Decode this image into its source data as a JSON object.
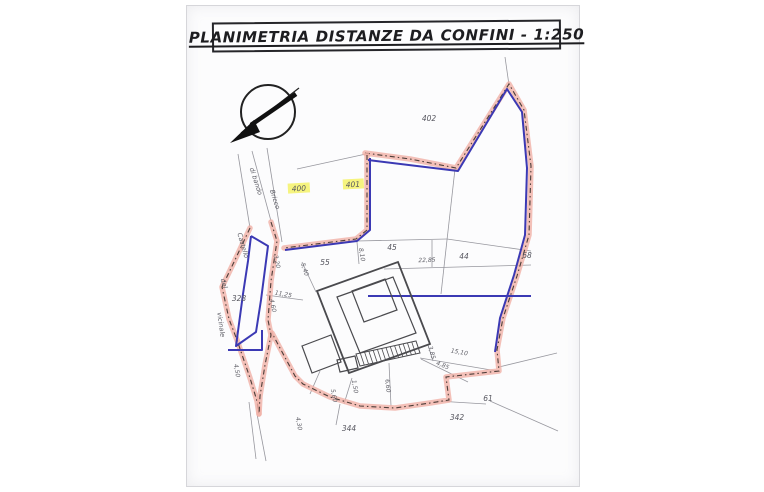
{
  "title": {
    "text": "PLANIMETRIA DISTANZE DA CONFINI - 1:250"
  },
  "colors": {
    "paper": "#fcfcfd",
    "pink_band": "#f0b0a6",
    "dash_ink": "#2e2622",
    "blue_line": "#3b39b4",
    "thin_line": "#97979e",
    "building": "#4a4a4e",
    "label": "#55555e",
    "dimension": "#606068",
    "road": "#5a5a62",
    "highlight": "#f4f268",
    "ink": "#222222"
  },
  "map": {
    "pink_boundaries": [
      {
        "name": "perimeter-east",
        "points": [
          [
            365,
            153
          ],
          [
            410,
            159
          ],
          [
            456,
            168
          ],
          [
            509,
            84
          ],
          [
            524,
            110
          ],
          [
            531,
            166
          ],
          [
            529,
            235
          ],
          [
            517,
            276
          ],
          [
            503,
            318
          ],
          [
            497,
            350
          ],
          [
            499,
            371
          ],
          [
            446,
            377
          ],
          [
            449,
            400
          ],
          [
            430,
            403
          ],
          [
            395,
            408
          ],
          [
            360,
            406
          ],
          [
            330,
            397
          ],
          [
            303,
            384
          ],
          [
            295,
            376
          ],
          [
            281,
            350
          ],
          [
            272,
            333
          ]
        ]
      },
      {
        "name": "road-west-band",
        "points": [
          [
            250,
            228
          ],
          [
            234,
            262
          ],
          [
            222,
            287
          ],
          [
            229,
            319
          ],
          [
            237,
            340
          ],
          [
            250,
            378
          ],
          [
            257,
            401
          ],
          [
            259,
            414
          ]
        ]
      },
      {
        "name": "road-middle-band",
        "points": [
          [
            271,
            222
          ],
          [
            277,
            241
          ],
          [
            271,
            281
          ],
          [
            268,
            320
          ],
          [
            271,
            335
          ],
          [
            265,
            365
          ],
          [
            260,
            396
          ],
          [
            259,
            414
          ]
        ]
      },
      {
        "name": "north-court-band",
        "points": [
          [
            367,
            155
          ],
          [
            367,
            230
          ],
          [
            356,
            239
          ],
          [
            284,
            248
          ]
        ]
      }
    ],
    "blue_lines": [
      {
        "name": "blue-perimeter-east",
        "points": [
          [
            368,
            160
          ],
          [
            458,
            171
          ],
          [
            507,
            89
          ],
          [
            522,
            112
          ],
          [
            527,
            168
          ],
          [
            525,
            235
          ],
          [
            514,
            275
          ],
          [
            500,
            318
          ],
          [
            495,
            352
          ]
        ]
      },
      {
        "name": "blue-mid-horizontal",
        "points": [
          [
            368,
            296
          ],
          [
            531,
            296
          ]
        ]
      },
      {
        "name": "blue-north-court",
        "points": [
          [
            370,
            158
          ],
          [
            370,
            230
          ],
          [
            357,
            241
          ],
          [
            285,
            250
          ]
        ]
      },
      {
        "name": "blue-strip-328",
        "points": [
          [
            251,
            236
          ],
          [
            268,
            246
          ],
          [
            261,
            300
          ],
          [
            256,
            332
          ],
          [
            236,
            346
          ],
          [
            243,
            294
          ],
          [
            248,
            261
          ],
          [
            251,
            236
          ]
        ]
      },
      {
        "name": "blue-south-corner",
        "points": [
          [
            228,
            350
          ],
          [
            262,
            350
          ],
          [
            262,
            330
          ]
        ]
      }
    ],
    "thin_lines": [
      [
        505,
        57,
        509,
        85
      ],
      [
        297,
        169,
        366,
        154
      ],
      [
        238,
        154,
        250,
        228
      ],
      [
        252,
        151,
        271,
        221
      ],
      [
        267,
        148,
        282,
        242
      ],
      [
        257,
        414,
        266,
        461
      ],
      [
        249,
        402,
        256,
        459
      ],
      [
        455,
        169,
        447,
        240
      ],
      [
        357,
        241,
        447,
        239
      ],
      [
        447,
        239,
        531,
        251
      ],
      [
        432,
        240,
        432,
        267
      ],
      [
        384,
        269,
        531,
        265
      ],
      [
        447,
        240,
        441,
        294
      ],
      [
        499,
        367,
        557,
        353
      ],
      [
        490,
        401,
        558,
        431
      ],
      [
        437,
        401,
        486,
        404
      ],
      [
        420,
        358,
        497,
        371
      ],
      [
        421,
        359,
        468,
        382
      ],
      [
        389,
        363,
        391,
        406
      ],
      [
        352,
        378,
        344,
        404
      ],
      [
        320,
        371,
        310,
        394
      ],
      [
        340,
        404,
        336,
        425
      ],
      [
        302,
        262,
        316,
        292
      ],
      [
        357,
        242,
        359,
        264
      ],
      [
        266,
        295,
        303,
        300
      ],
      [
        428,
        345,
        433,
        361
      ]
    ],
    "building": {
      "outer": [
        [
          317,
          291
        ],
        [
          398,
          262
        ],
        [
          430,
          344
        ],
        [
          349,
          373
        ]
      ],
      "inner": [
        [
          337,
          297
        ],
        [
          393,
          277
        ],
        [
          416,
          333
        ],
        [
          360,
          353
        ]
      ],
      "core": [
        [
          352,
          291
        ],
        [
          385,
          279
        ],
        [
          397,
          310
        ],
        [
          364,
          322
        ]
      ],
      "wing": [
        [
          302,
          346
        ],
        [
          331,
          335
        ],
        [
          341,
          362
        ],
        [
          312,
          373
        ]
      ],
      "step": [
        [
          337,
          360
        ],
        [
          355,
          356
        ],
        [
          358,
          368
        ],
        [
          340,
          372
        ]
      ],
      "stairs": [
        [
          356,
          354
        ],
        [
          416,
          341
        ],
        [
          420,
          353
        ],
        [
          360,
          366
        ]
      ]
    },
    "highlight_labels": [
      {
        "text": "400",
        "rect": [
          288,
          183,
          22,
          10
        ],
        "tx": 299,
        "ty": 191
      },
      {
        "text": "401",
        "rect": [
          343,
          179,
          21,
          10
        ],
        "tx": 353,
        "ty": 187
      }
    ],
    "parcel_labels": [
      {
        "text": "402",
        "x": 429,
        "y": 121
      },
      {
        "text": "45",
        "x": 392,
        "y": 250
      },
      {
        "text": "44",
        "x": 464,
        "y": 259
      },
      {
        "text": "68",
        "x": 527,
        "y": 258
      },
      {
        "text": "55",
        "x": 325,
        "y": 265
      },
      {
        "text": "328",
        "x": 239,
        "y": 301
      },
      {
        "text": "344",
        "x": 349,
        "y": 431
      },
      {
        "text": "342",
        "x": 457,
        "y": 420
      },
      {
        "text": "61",
        "x": 488,
        "y": 401
      }
    ],
    "dimension_labels": [
      {
        "text": "22,85",
        "x": 427,
        "y": 262,
        "rot": -2
      },
      {
        "text": "15,10",
        "x": 459,
        "y": 354,
        "rot": 10
      },
      {
        "text": "4,85",
        "x": 442,
        "y": 367,
        "rot": 22
      },
      {
        "text": "6,60",
        "x": 386,
        "y": 386,
        "rot": 85
      },
      {
        "text": "3,85",
        "x": 430,
        "y": 353,
        "rot": 75
      },
      {
        "text": "8,10",
        "x": 360,
        "y": 255,
        "rot": 80
      },
      {
        "text": "5,40",
        "x": 303,
        "y": 270,
        "rot": 72
      },
      {
        "text": "11,25",
        "x": 283,
        "y": 296,
        "rot": 10
      },
      {
        "text": "3,20",
        "x": 275,
        "y": 262,
        "rot": 78
      },
      {
        "text": "4,60",
        "x": 271,
        "y": 306,
        "rot": 78
      },
      {
        "text": "4,50",
        "x": 235,
        "y": 371,
        "rot": 80
      },
      {
        "text": "5,60",
        "x": 332,
        "y": 396,
        "rot": 80
      },
      {
        "text": "1,50",
        "x": 353,
        "y": 387,
        "rot": 80
      },
      {
        "text": "4,30",
        "x": 297,
        "y": 424,
        "rot": 80
      }
    ],
    "road_labels": [
      {
        "text": "di bando",
        "x": 254,
        "y": 182,
        "rot": 72
      },
      {
        "text": "Bricco",
        "x": 273,
        "y": 200,
        "rot": 72
      },
      {
        "text": "Castello",
        "x": 241,
        "y": 246,
        "rot": 74
      },
      {
        "text": "del",
        "x": 222,
        "y": 284,
        "rot": 74
      },
      {
        "text": "vicinale",
        "x": 219,
        "y": 325,
        "rot": 82
      }
    ]
  }
}
